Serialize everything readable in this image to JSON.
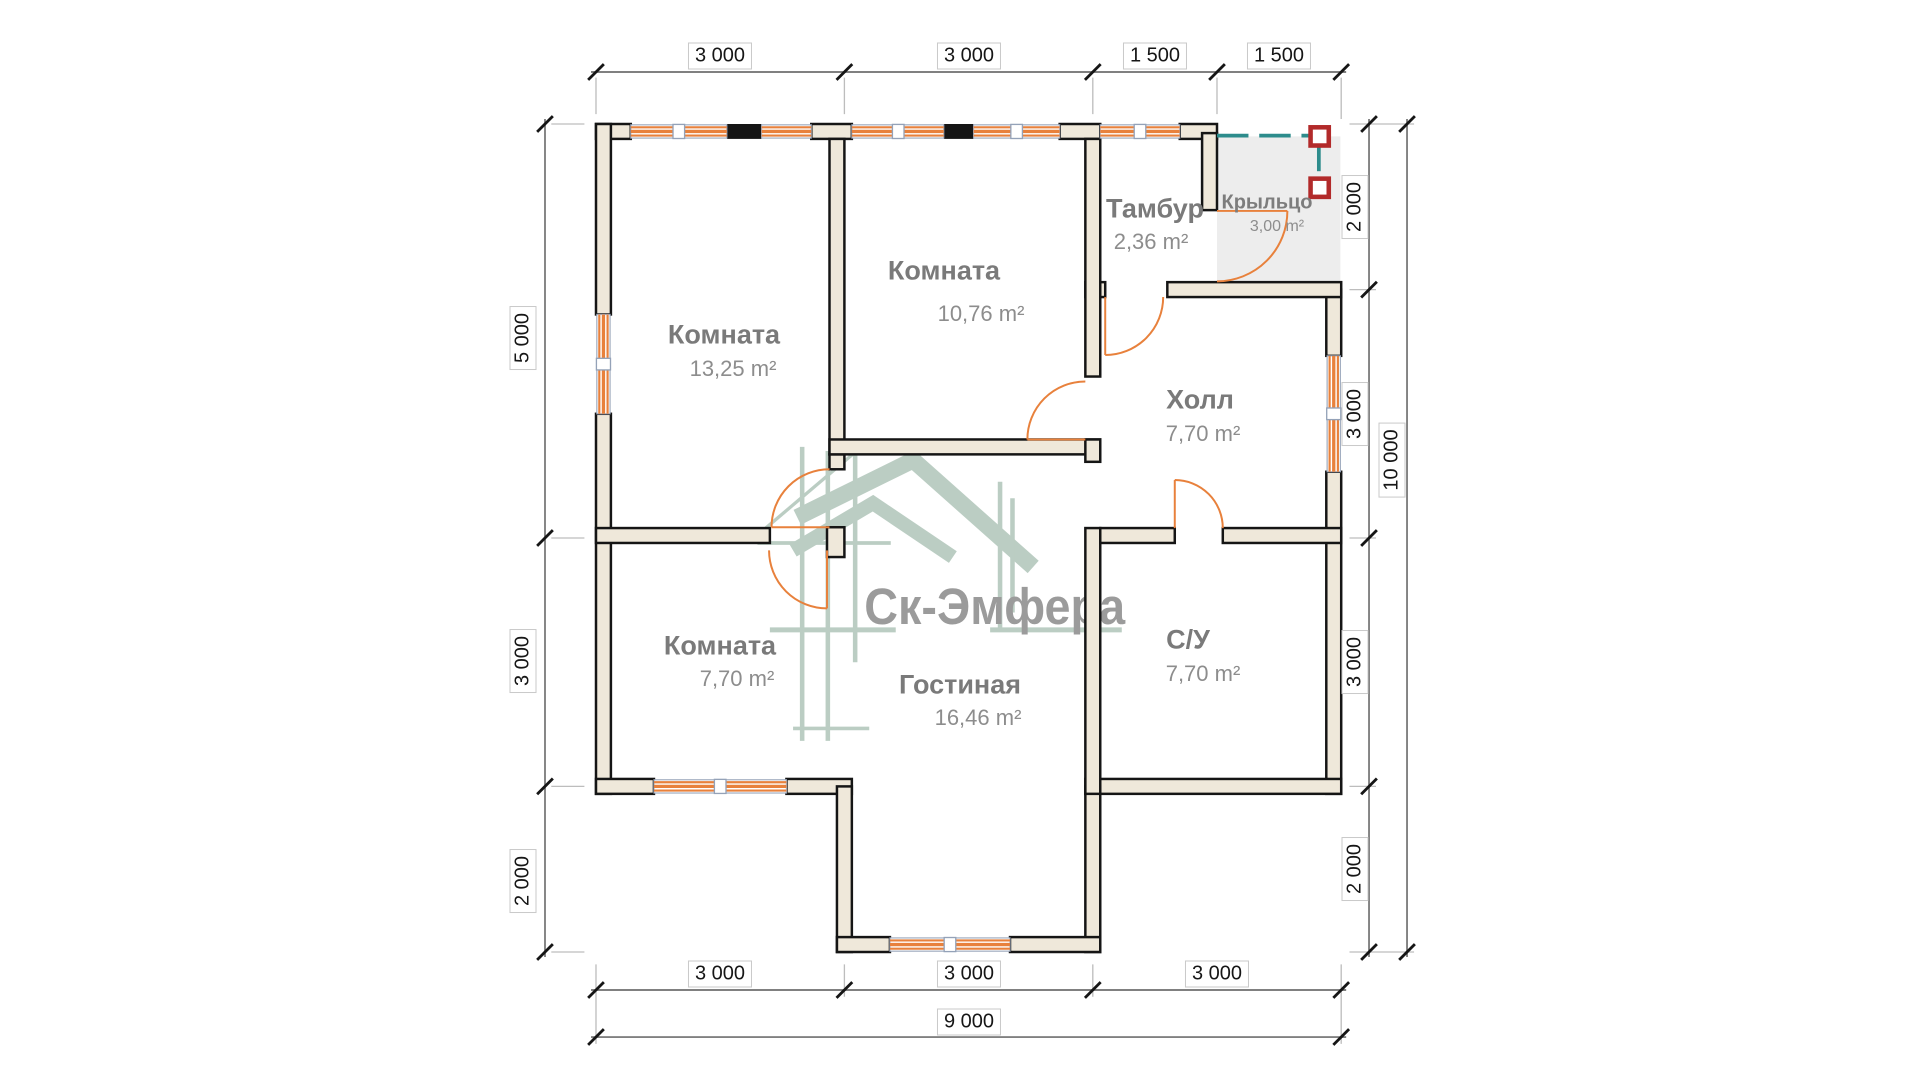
{
  "plan": {
    "watermark": "Ск-Эмфера",
    "rooms": [
      {
        "id": "bedroom-1",
        "name": "Комната",
        "area": "13,25 m²"
      },
      {
        "id": "bedroom-2",
        "name": "Комната",
        "area": "10,76 m²"
      },
      {
        "id": "tambour",
        "name": "Тамбур",
        "area": "2,36 m²"
      },
      {
        "id": "porch",
        "name": "Крыльцо",
        "area": "3,00 m²"
      },
      {
        "id": "hall",
        "name": "Холл",
        "area": "7,70 m²"
      },
      {
        "id": "bedroom-3",
        "name": "Комната",
        "area": "7,70 m²"
      },
      {
        "id": "living-room",
        "name": "Гостиная",
        "area": "16,46 m²"
      },
      {
        "id": "bathroom",
        "name": "С/У",
        "area": "7,70 m²"
      }
    ],
    "dims": {
      "top": [
        "3 000",
        "3 000",
        "1 500",
        "1 500"
      ],
      "left": [
        "5 000",
        "3 000",
        "2 000"
      ],
      "right": [
        "2 000",
        "3 000",
        "3 000",
        "2 000"
      ],
      "right_total": "10 000",
      "bottom": [
        "3 000",
        "3 000",
        "3 000"
      ],
      "bottom_total": "9 000"
    },
    "colors": {
      "wall_fill": "#efe8da",
      "wall_line": "#151515",
      "window_door_orange": "#e8813c",
      "railing_teal": "#2d8c8c",
      "post_red": "#b22a2a",
      "porch_fill": "#ededed",
      "watermark_sage": "#a9c0b3",
      "watermark_text_gray": "#9b9b9b"
    }
  }
}
